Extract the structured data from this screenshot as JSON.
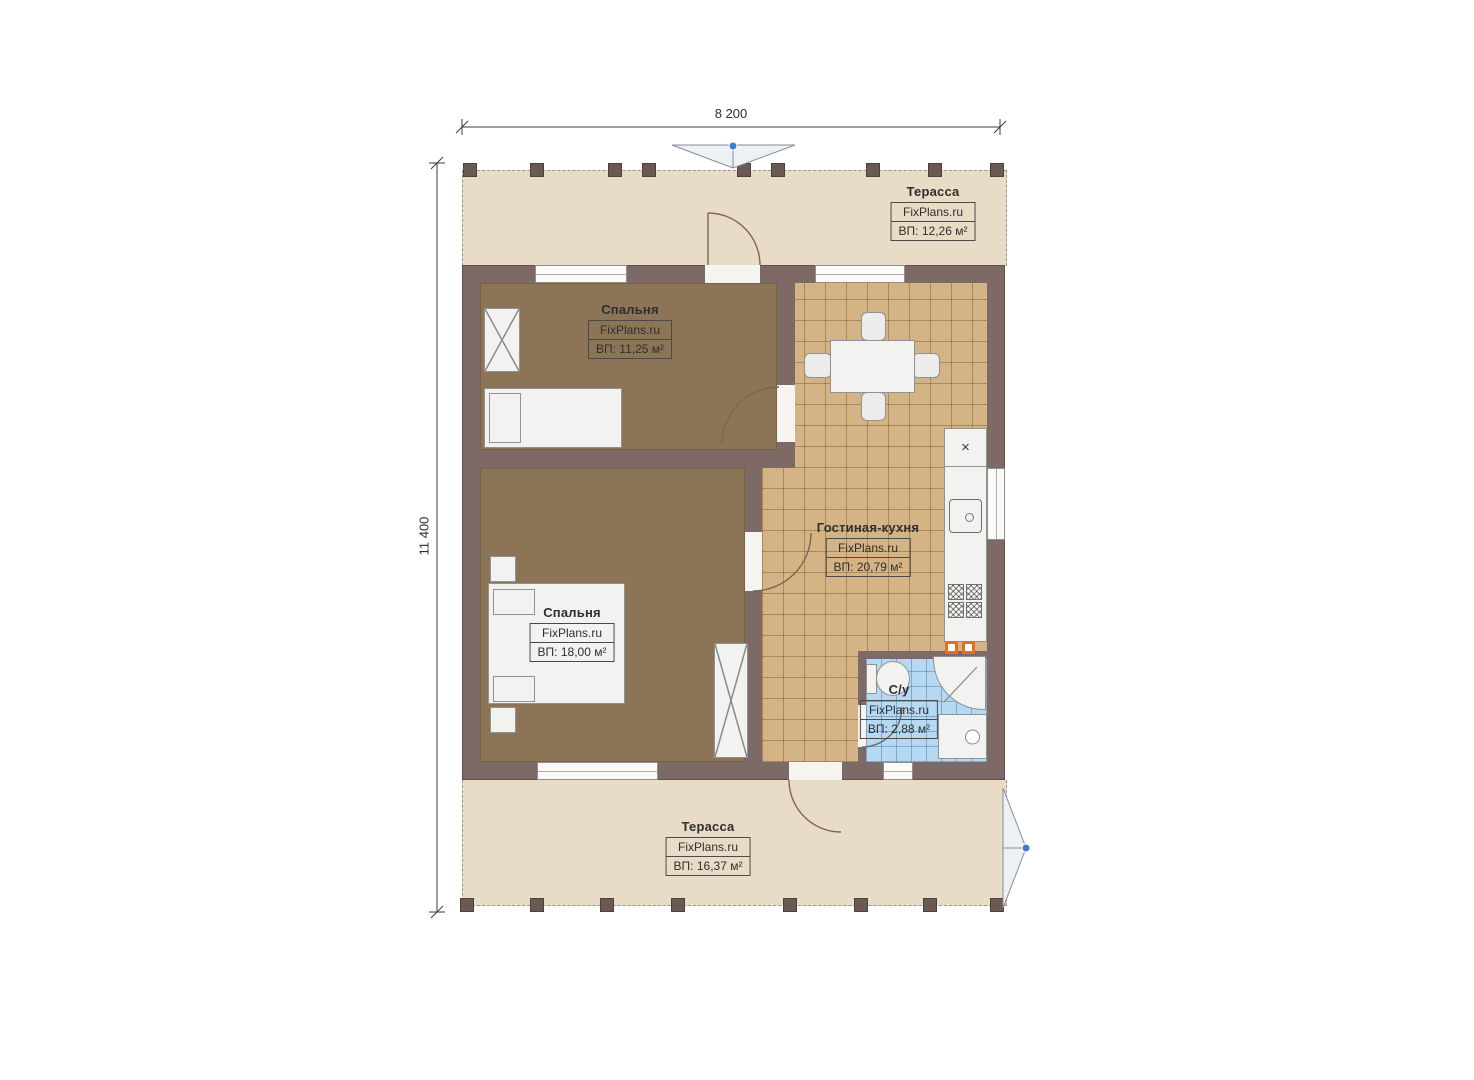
{
  "plan": {
    "watermark": "FixPlans.ru",
    "dimensions": {
      "width": "8 200",
      "height": "11 400"
    },
    "rooms": {
      "terrace_top": {
        "name": "Терасса",
        "area_label": "ВП: 12,26 м²"
      },
      "bedroom_top": {
        "name": "Спальня",
        "area_label": "ВП: 11,25 м²"
      },
      "living_kitchen": {
        "name": "Гостиная-кухня",
        "area_label": "ВП: 20,79 м²"
      },
      "bedroom_main": {
        "name": "Спальня",
        "area_label": "ВП: 18,00 м²"
      },
      "bathroom": {
        "name": "С/у",
        "area_label": "ВП: 2,88 м²"
      },
      "terrace_bottom": {
        "name": "Терасса",
        "area_label": "ВП: 16,37 м²"
      }
    },
    "colors": {
      "wall": "#7d6a66",
      "terrace_floor": "#e9dcc6",
      "bedroom_floor": "#8c7456",
      "kitchen_tile": "#d4b385",
      "bathroom_tile": "#b5d8f3",
      "accent_orange": "#e2711d",
      "handle_dot_blue": "#3f7bd0"
    }
  }
}
